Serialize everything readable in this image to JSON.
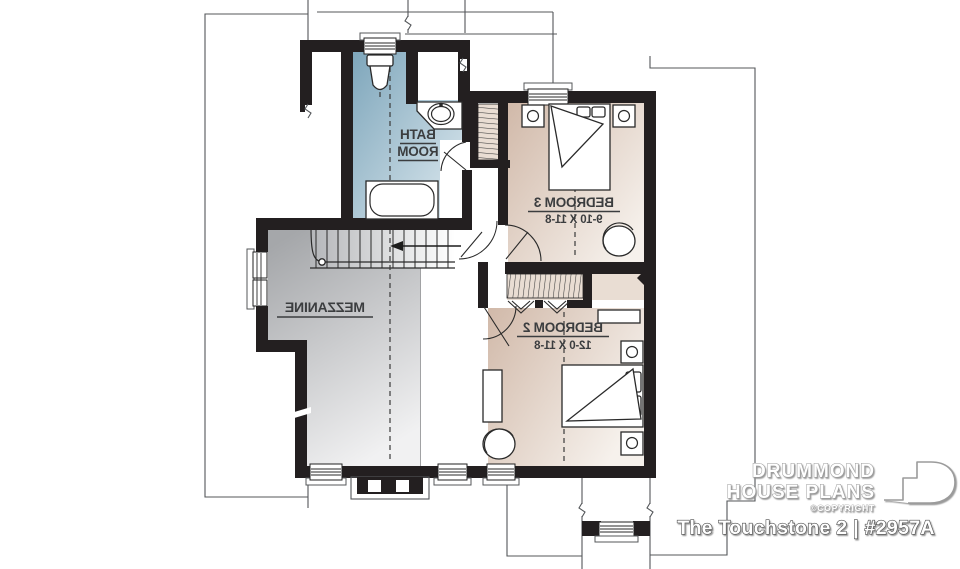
{
  "plan": {
    "rooms": [
      {
        "id": "bath-room",
        "line1": "BATH",
        "line2": "ROOM"
      },
      {
        "id": "bedroom-3",
        "label": "BEDROOM 3",
        "dimensions": "9-10 X 11-8"
      },
      {
        "id": "mezzanine",
        "label": "MEZZANINE"
      },
      {
        "id": "bedroom-2",
        "label": "BEDROOM 2",
        "dimensions": "12-0 X 11-8"
      }
    ]
  },
  "branding": {
    "brand_line1": "DRUMMOND",
    "brand_line2": "HOUSE PLANS",
    "copyright": "©COPYRIGHT",
    "plan_title": "The Touchstone 2 | #2957A"
  },
  "colors": {
    "wall": "#231f20",
    "bath_dark": "#7ea6bb",
    "bath_light": "#dde9ef",
    "bedroom_dark": "#d1b9a9",
    "bedroom_light": "#f6f1ec",
    "closet_fill": "#e9ddd3",
    "mezzanine_dark": "#a5a7aa",
    "mezzanine_light": "#f1f1f2",
    "stairs_dark": "#b4b6b9",
    "label_text": "#3b3d3f",
    "outline": "#54575a"
  }
}
